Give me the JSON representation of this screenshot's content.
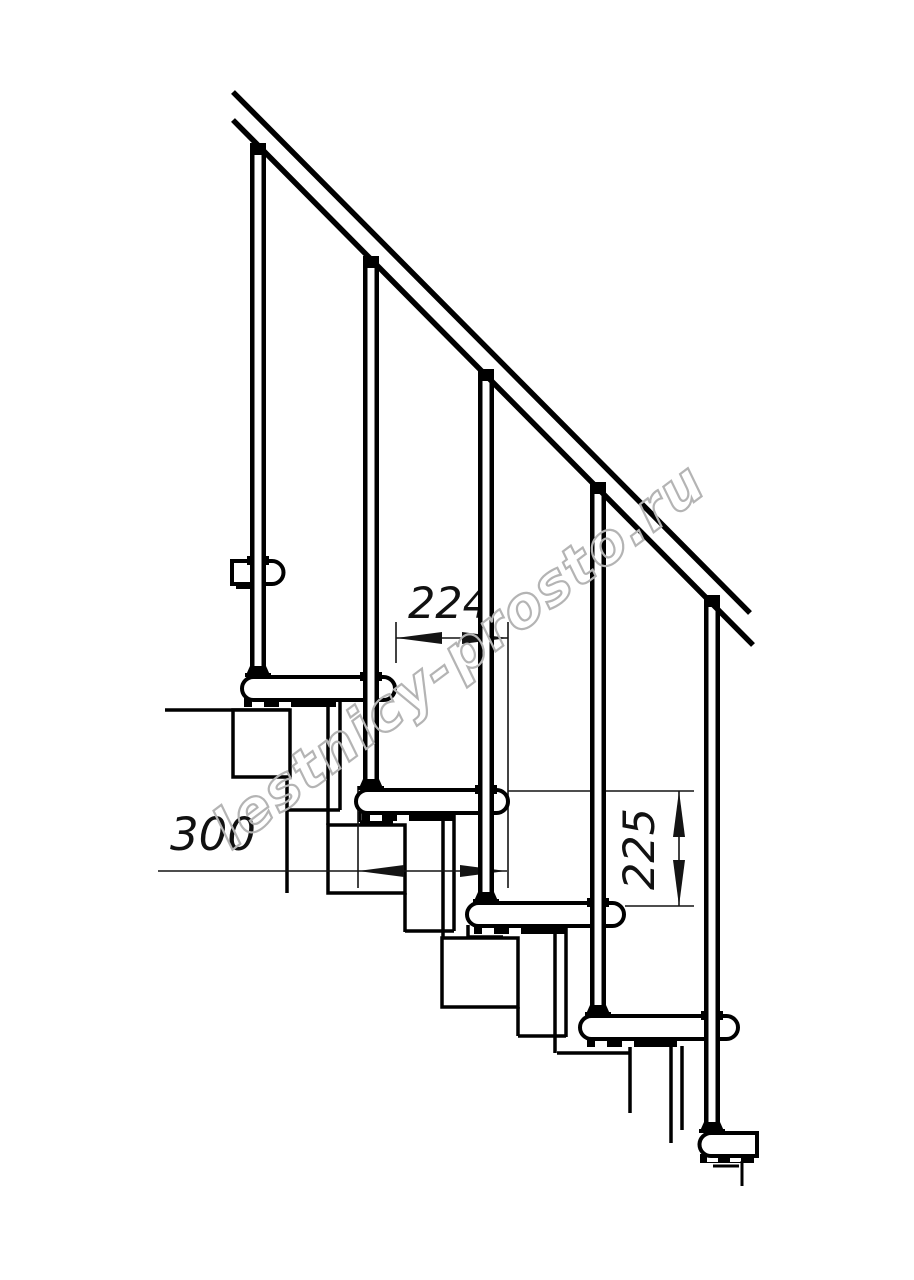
{
  "canvas": {
    "background": "#ffffff",
    "line_color": "#000000",
    "dimension_line_color": "#141414"
  },
  "watermark": {
    "text": "lestnicy-prosto.ru",
    "color": "#b4b4b4"
  },
  "dimensions": {
    "going": {
      "value": "224",
      "orientation": "horizontal",
      "meaning": "step going between tread edges"
    },
    "tread_depth": {
      "value": "300",
      "orientation": "horizontal",
      "meaning": "tread depth"
    },
    "rise": {
      "value": "225",
      "orientation": "vertical",
      "meaning": "step rise between tread tops"
    }
  },
  "structure": {
    "drawing_type": "staircase side elevation",
    "balusters": 5,
    "treads": 6,
    "modules": 4,
    "handrail": 1
  }
}
